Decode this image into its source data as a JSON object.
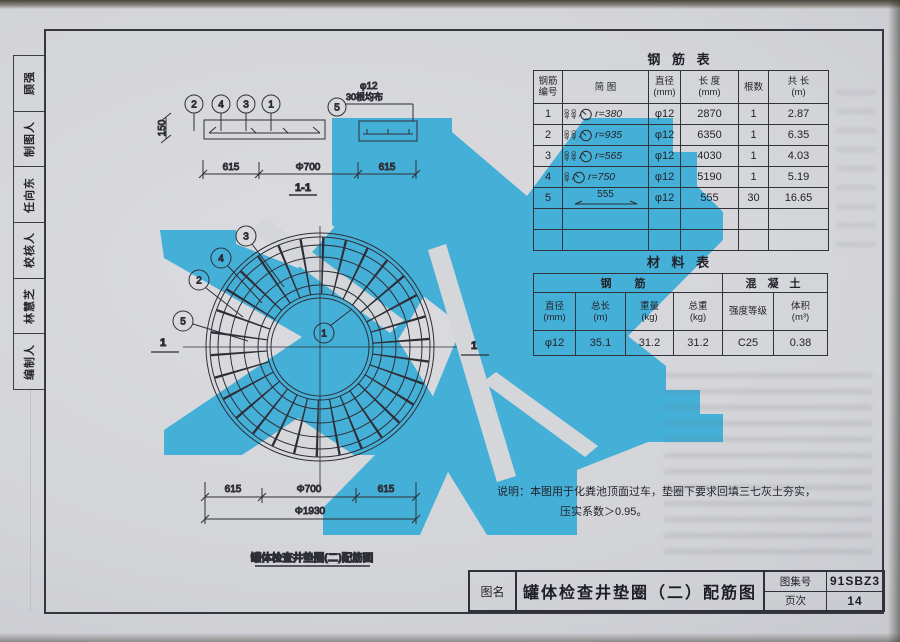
{
  "photo": {
    "accent_blue": "#45b0d7",
    "paper": "#d5d6da",
    "line": "#2e2e37"
  },
  "sidebar": {
    "cells": [
      "顾强",
      "制图人",
      "任向东",
      "校核人",
      "林慧芝",
      "编制人"
    ]
  },
  "section_view": {
    "callouts": [
      "2",
      "4",
      "3",
      "1"
    ],
    "callout_5": "5",
    "bar_note_dia": "φ12",
    "bar_note_count": "30根均布",
    "height_dim": "150",
    "dims": [
      "615",
      "Φ700",
      "615"
    ],
    "caption": "1-1"
  },
  "plan_view": {
    "callout_3": "3",
    "callout_4": "4",
    "callout_2": "2",
    "callout_5": "5",
    "callout_1": "1",
    "section_mark": "1",
    "dims": [
      "615",
      "Φ700",
      "615"
    ],
    "dim_total": "Φ1930",
    "caption": "罐体检查井垫圈(二)配筋图"
  },
  "rebar_table": {
    "title": "钢 筋 表",
    "headers": [
      {
        "l1": "钢筋",
        "l2": "编号"
      },
      {
        "l1": "简  图",
        "l2": ""
      },
      {
        "l1": "直径",
        "l2": "(mm)"
      },
      {
        "l1": "长 度",
        "l2": "(mm)"
      },
      {
        "l1": "根数",
        "l2": ""
      },
      {
        "l1": "共 长",
        "l2": "(m)"
      }
    ],
    "rows": [
      {
        "no": "1",
        "pre": "480 480",
        "r": "r=380",
        "dia": "φ12",
        "len": "2870",
        "qty": "1",
        "total": "2.87"
      },
      {
        "no": "2",
        "pre": "480 480",
        "r": "r=935",
        "dia": "φ12",
        "len": "6350",
        "qty": "1",
        "total": "6.35"
      },
      {
        "no": "3",
        "pre": "480 480",
        "r": "r=565",
        "dia": "φ12",
        "len": "4030",
        "qty": "1",
        "total": "4.03"
      },
      {
        "no": "4",
        "pre": "480",
        "r": "r=750",
        "dia": "φ12",
        "len": "5190",
        "qty": "1",
        "total": "5.19"
      },
      {
        "no": "5",
        "seg": "555",
        "dia": "φ12",
        "len": "555",
        "qty": "30",
        "total": "16.65"
      }
    ]
  },
  "material_table": {
    "title": "材 料 表",
    "group_steel": "钢  筋",
    "group_concrete": "混 凝 土",
    "headers": [
      {
        "l1": "直径",
        "l2": "(mm)"
      },
      {
        "l1": "总长",
        "l2": "(m)"
      },
      {
        "l1": "重量",
        "l2": "(kg)"
      },
      {
        "l1": "总重",
        "l2": "(kg)"
      },
      {
        "l1": "强度等级",
        "l2": ""
      },
      {
        "l1": "体积",
        "l2": "(m³)"
      }
    ],
    "row": [
      "φ12",
      "35.1",
      "31.2",
      "31.2",
      "C25",
      "0.38"
    ]
  },
  "notes": {
    "line1": "说明：本图用于化粪池顶面过车，垫圈下要求回填三七灰土夯实，",
    "line2": "压实系数＞0.95。"
  },
  "title_block": {
    "name_label": "图名",
    "title": "罐体检查井垫圈（二）配筋图",
    "atlas_label": "图集号",
    "atlas_no": "91SBZ3",
    "page_label": "页次",
    "page_no": "14"
  }
}
